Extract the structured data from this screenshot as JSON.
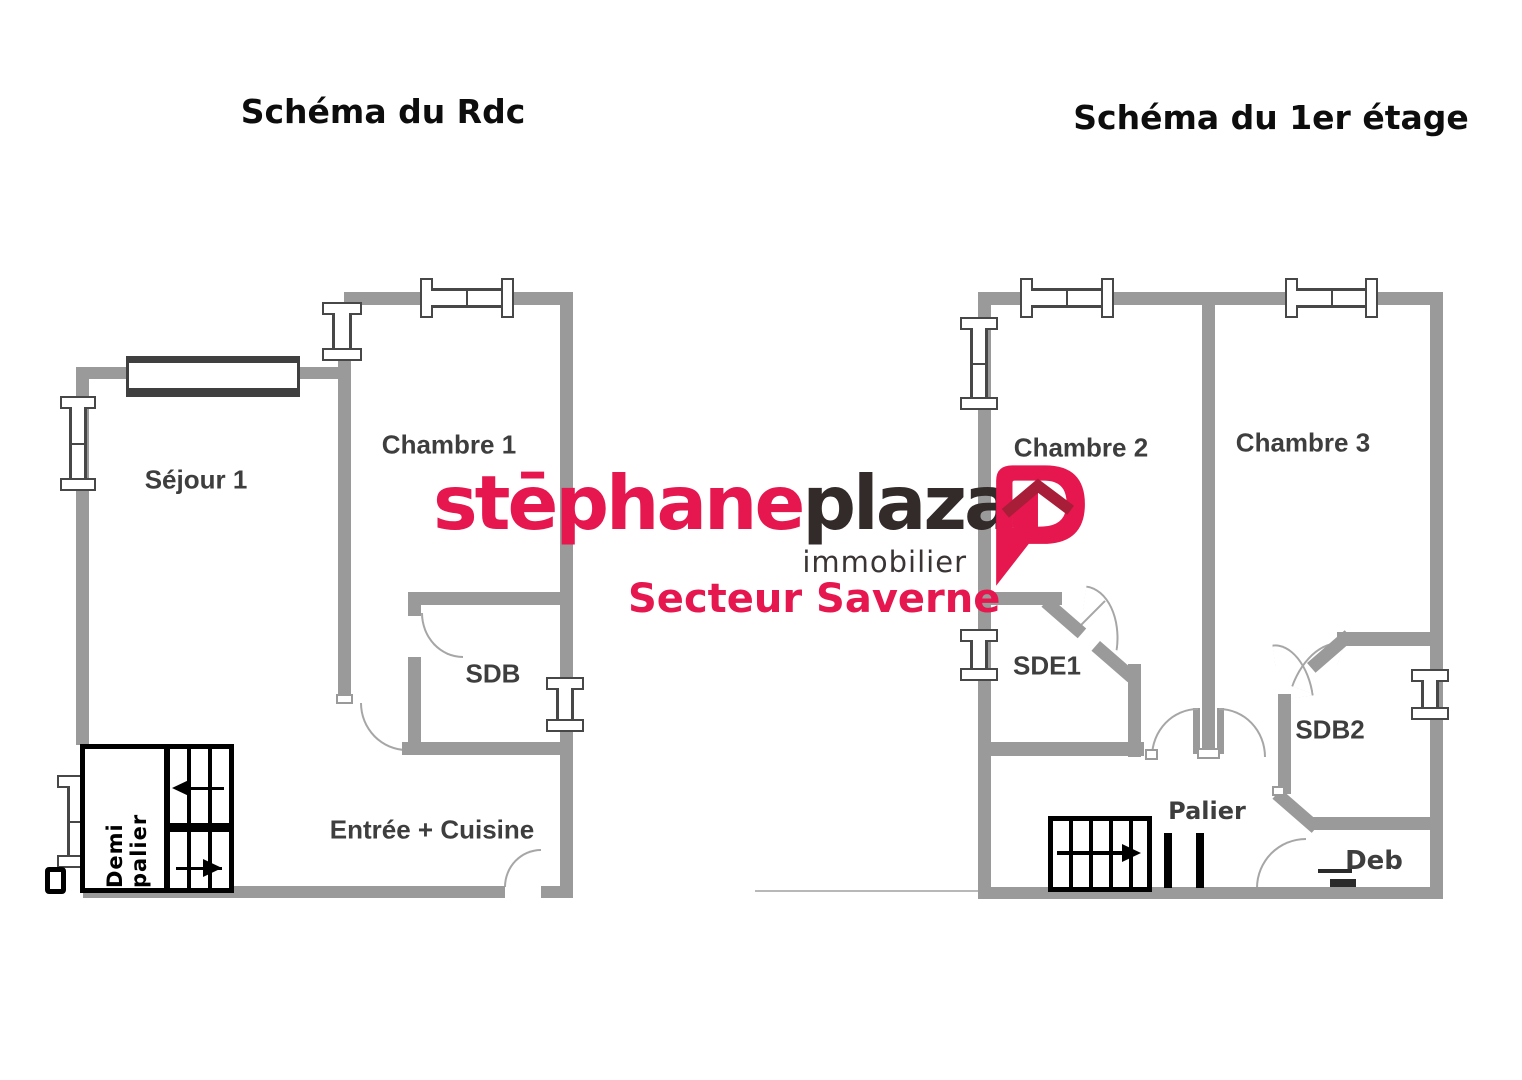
{
  "page": {
    "width": 1522,
    "height": 1080,
    "background": "#ffffff"
  },
  "titles": {
    "ground": "Schéma du Rdc",
    "first": "Schéma du 1er étage"
  },
  "logo": {
    "brand_first": "stēphane",
    "brand_second": "plaza",
    "subtitle": "immobilier",
    "sector": "Secteur Saverne",
    "icon": "p-speech-bubble-with-house-roof"
  },
  "ground_floor": {
    "sejour": "Séjour 1",
    "chambre1": "Chambre 1",
    "sdb": "SDB",
    "entree_cuisine": "Entrée + Cuisine",
    "demi_palier": "Demi palier"
  },
  "first_floor": {
    "chambre2": "Chambre 2",
    "chambre3": "Chambre 3",
    "sde1": "SDE1",
    "sdb2": "SDB2",
    "palier": "Palier",
    "deb": "Deb"
  },
  "colors": {
    "wall": "#9a9a9a",
    "window_frame": "#474747",
    "long_window_frame": "#3f3f3f",
    "door_arc": "#a6a6a6",
    "stairs": "#000000",
    "room_label": "#3e3e3e",
    "title_text": "#0d0d0d",
    "logo_pink": "#e6164e",
    "logo_dark": "#332a2a",
    "logo_roof": "#a81e38"
  }
}
